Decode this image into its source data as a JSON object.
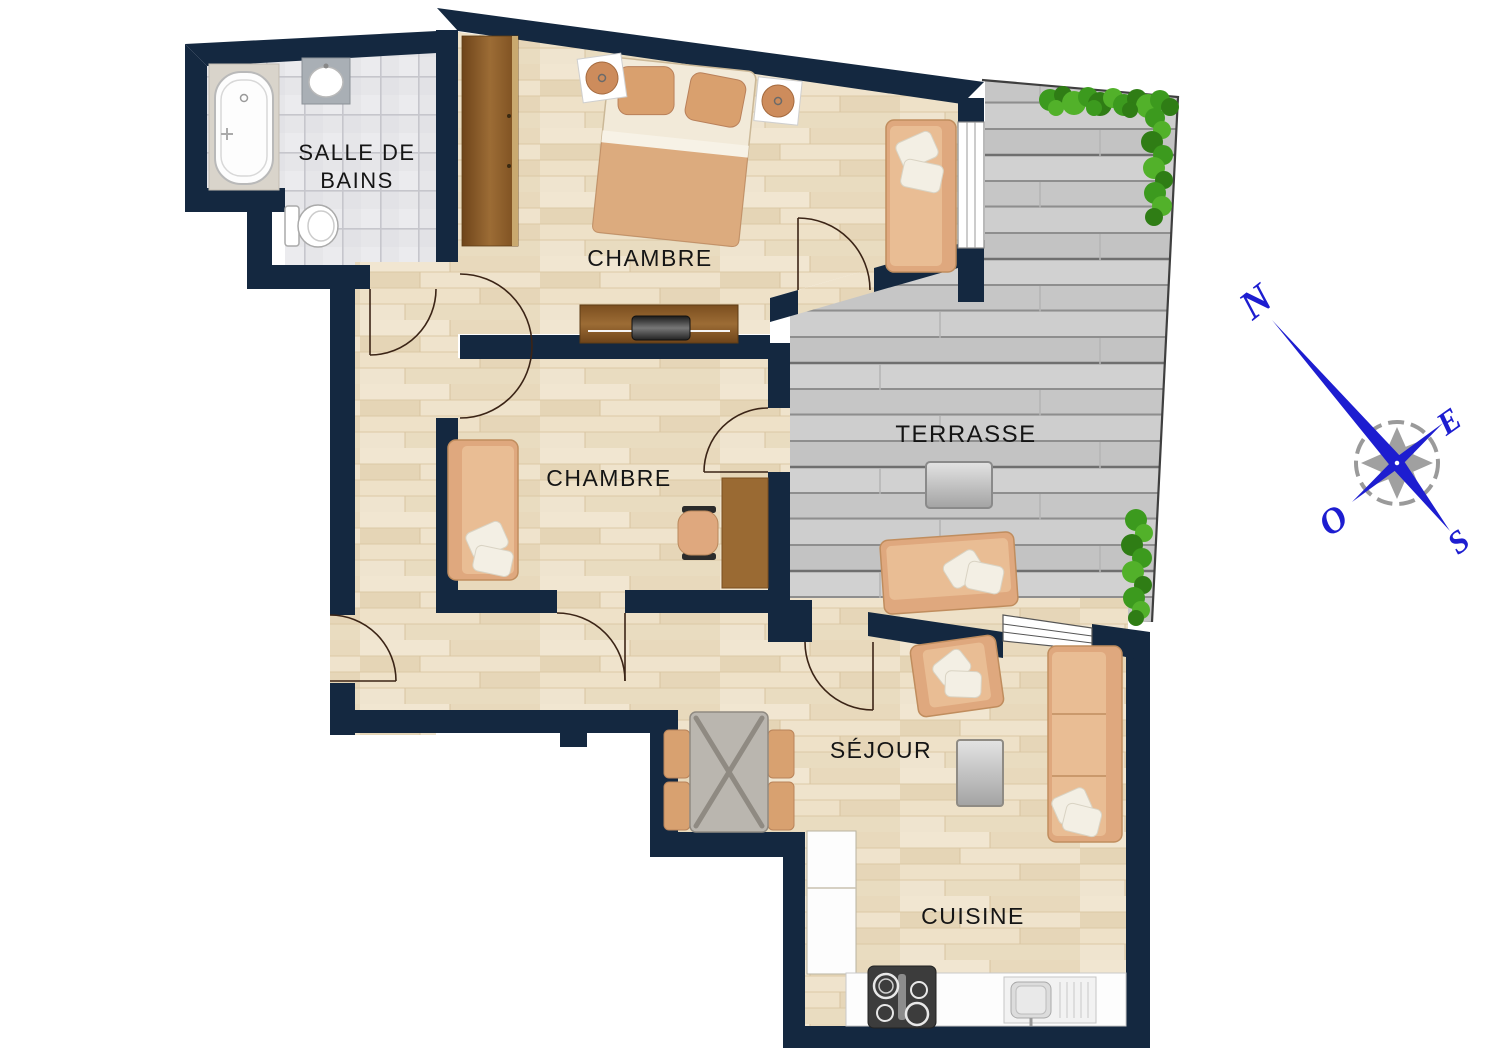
{
  "plan": {
    "title": "apartment-floor-plan",
    "rooms": [
      {
        "id": "salle-de-bains",
        "label": "SALLE DE",
        "label2": "BAINS"
      },
      {
        "id": "chambre-1",
        "label": "CHAMBRE"
      },
      {
        "id": "chambre-2",
        "label": "CHAMBRE"
      },
      {
        "id": "terrasse",
        "label": "TERRASSE"
      },
      {
        "id": "sejour",
        "label": "SÉJOUR"
      },
      {
        "id": "cuisine",
        "label": "CUISINE"
      }
    ],
    "compass": {
      "north": "N",
      "east": "E",
      "south": "S",
      "west": "O"
    },
    "colors": {
      "wall": "#142840",
      "wood_floor": "#ecdfc6",
      "tile_floor": "#e6e6e9",
      "deck": "#cacaca",
      "furniture_tan": "#dfa87e",
      "plant_green": "#3c9a1e",
      "compass_blue": "#1d1dd0"
    }
  }
}
